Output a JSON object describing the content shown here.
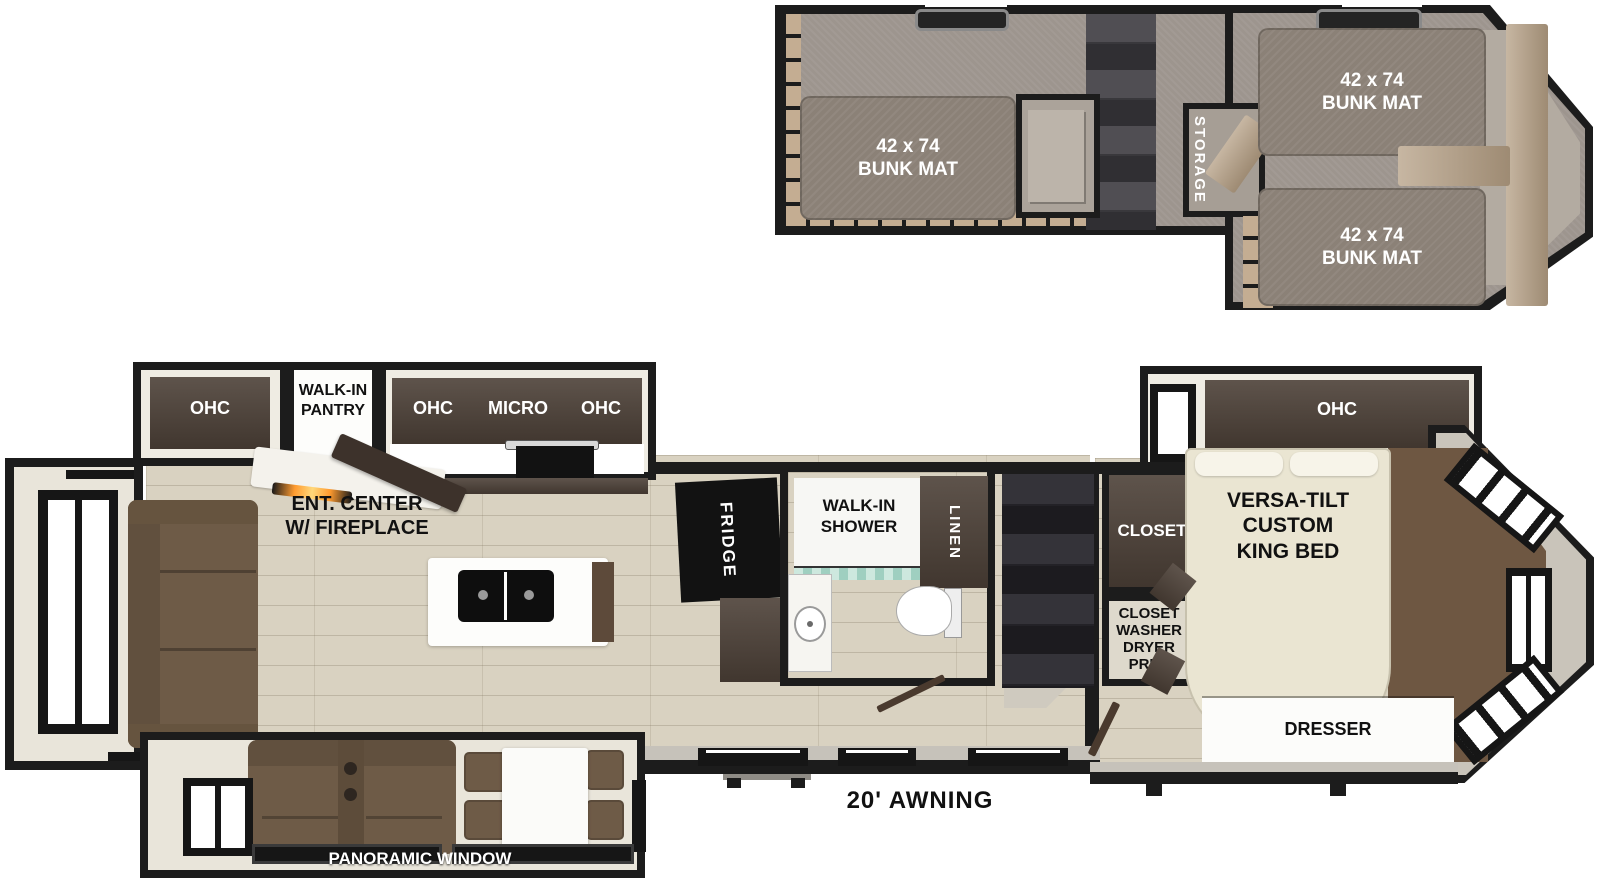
{
  "loft": {
    "bunk_mat_left": "42 x 74\nBUNK MAT",
    "bunk_mat_top_right": "42 x 74\nBUNK MAT",
    "bunk_mat_bottom_right": "42 x 74\nBUNK MAT",
    "storage_label": "STORAGE"
  },
  "kitchen": {
    "ohc_rear_label": "OHC",
    "pantry_label": "WALK-IN\nPANTRY",
    "ohc_left_label": "OHC",
    "micro_label": "MICRO",
    "ohc_right_label": "OHC",
    "ent_center_label": "ENT. CENTER\nW/ FIREPLACE",
    "fridge_label": "FRIDGE"
  },
  "bathroom": {
    "shower_label": "WALK-IN\nSHOWER",
    "linen_label": "LINEN"
  },
  "bedroom": {
    "closet_label": "CLOSET",
    "washer_prep_label": "CLOSET\nWASHER\nDRYER\nPREP",
    "bed_label": "VERSA-TILT\nCUSTOM\nKING BED",
    "ohc_label": "OHC",
    "dresser_label": "DRESSER"
  },
  "annotations": {
    "awning_label": "20' AWNING",
    "panoramic_window_label": "PANORAMIC WINDOW"
  },
  "colors": {
    "wall": "#1c1c1c",
    "wood_floor": "#d9d2c1",
    "loft_carpet": "#9d958e",
    "bunk_mat": "#8b8177",
    "dark_cabinet": "#4c4037",
    "sofa_brown": "#6e5b47",
    "bed_cream": "#eae5d2",
    "front_carpet": "#6e5742",
    "fireplace_glow": "#ff9b2f",
    "shower_curtain": "#bfe3d8"
  }
}
